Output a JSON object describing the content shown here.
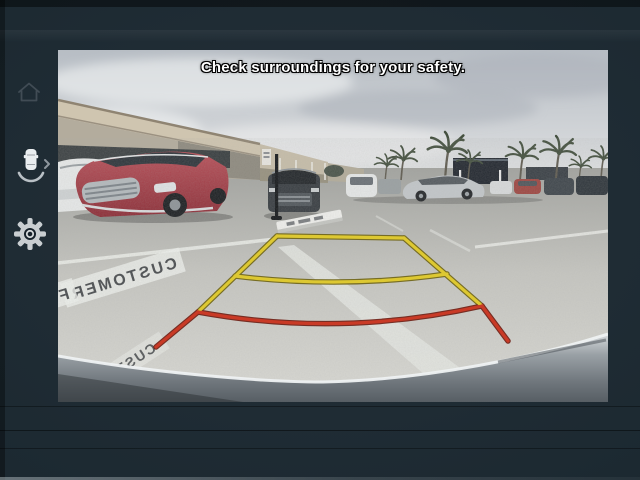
{
  "header": {
    "warning_text": "Check surroundings for your safety."
  },
  "sidebar": {
    "items": [
      {
        "id": "home",
        "icon": "home-icon"
      },
      {
        "id": "parking-assist",
        "icon": "car-sensor-icon"
      },
      {
        "id": "settings",
        "icon": "gear-icon"
      }
    ],
    "chevron_glyph": "›"
  },
  "camera": {
    "pavement_markings": {
      "primary": "CUSTOMER",
      "partial_letter": "F",
      "secondary": "CUSTOM"
    },
    "guidelines": {
      "yellow": "#ddc832",
      "yellow_edge": "#6f6414",
      "red": "#c93a26",
      "red_edge": "#6e1d12"
    }
  },
  "colors": {
    "bezel": "#1c2931"
  }
}
